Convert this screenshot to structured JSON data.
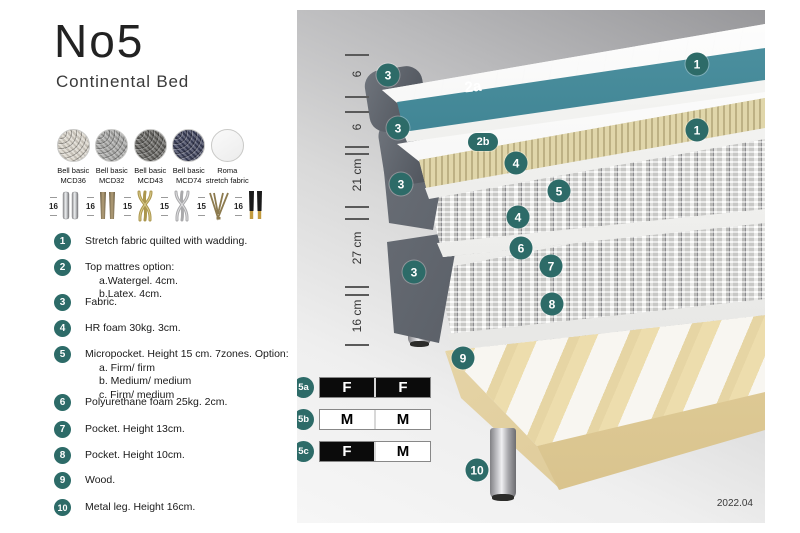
{
  "header": {
    "title": "No5",
    "subtitle": "Continental Bed"
  },
  "fabric_options": [
    {
      "line1": "Bell basic",
      "line2": "MCD36",
      "color": "#d9d4c9"
    },
    {
      "line1": "Bell basic",
      "line2": "MCD32",
      "color": "#a7a7a5"
    },
    {
      "line1": "Bell basic",
      "line2": "MCD43",
      "color": "#64635f"
    },
    {
      "line1": "Bell basic",
      "line2": "MCD74",
      "color": "#3c405a"
    },
    {
      "line1": "Roma",
      "line2": "stretch fabric",
      "color": "#f1f1f1"
    }
  ],
  "leg_options": [
    {
      "height": "16",
      "name": "chrome cylinder legs"
    },
    {
      "height": "16",
      "name": "bronze cone legs"
    },
    {
      "height": "15",
      "name": "gold twist legs"
    },
    {
      "height": "15",
      "name": "silver twist legs"
    },
    {
      "height": "15",
      "name": "hairpin leg"
    },
    {
      "height": "16",
      "name": "black gold-tip legs"
    }
  ],
  "features": [
    {
      "num": "1",
      "lines": [
        "Stretch fabric quilted with wadding."
      ]
    },
    {
      "num": "2",
      "lines": [
        "Top mattres option:",
        "a.Watergel. 4cm.",
        "b.Latex. 4cm."
      ]
    },
    {
      "num": "3",
      "lines": [
        "Fabric."
      ]
    },
    {
      "num": "4",
      "lines": [
        "HR foam 30kg. 3cm."
      ]
    },
    {
      "num": "5",
      "lines": [
        "Micropocket. Height 15 cm. 7zones. Option:",
        "a. Firm/ firm",
        "b. Medium/ medium",
        "c. Firm/ medium"
      ]
    },
    {
      "num": "6",
      "lines": [
        "Polyurethane foam 25kg. 2cm."
      ]
    },
    {
      "num": "7",
      "lines": [
        "Pocket. Height 13cm."
      ]
    },
    {
      "num": "8",
      "lines": [
        "Pocket. Height 10cm."
      ]
    },
    {
      "num": "9",
      "lines": [
        "Wood."
      ]
    },
    {
      "num": "10",
      "lines": [
        "Metal leg. Height 16cm."
      ]
    }
  ],
  "diagram": {
    "measurements": [
      "6",
      "6",
      "21 cm",
      "27 cm",
      "16 cm"
    ],
    "badges": {
      "n1": "1",
      "n2a": "2a",
      "n2b": "2b",
      "n3": "3",
      "n4": "4",
      "n5": "5",
      "n6": "6",
      "n7": "7",
      "n8": "8",
      "n9": "9",
      "n10": "10"
    },
    "firmness": [
      {
        "id": "5a",
        "left": "F",
        "right": "F"
      },
      {
        "id": "5b",
        "left": "M",
        "right": "M"
      },
      {
        "id": "5c",
        "left": "F",
        "right": "M"
      }
    ],
    "version": "2022.04"
  },
  "colors": {
    "accent_teal": "#2d6b68",
    "watergel_teal": "#2f7484"
  }
}
